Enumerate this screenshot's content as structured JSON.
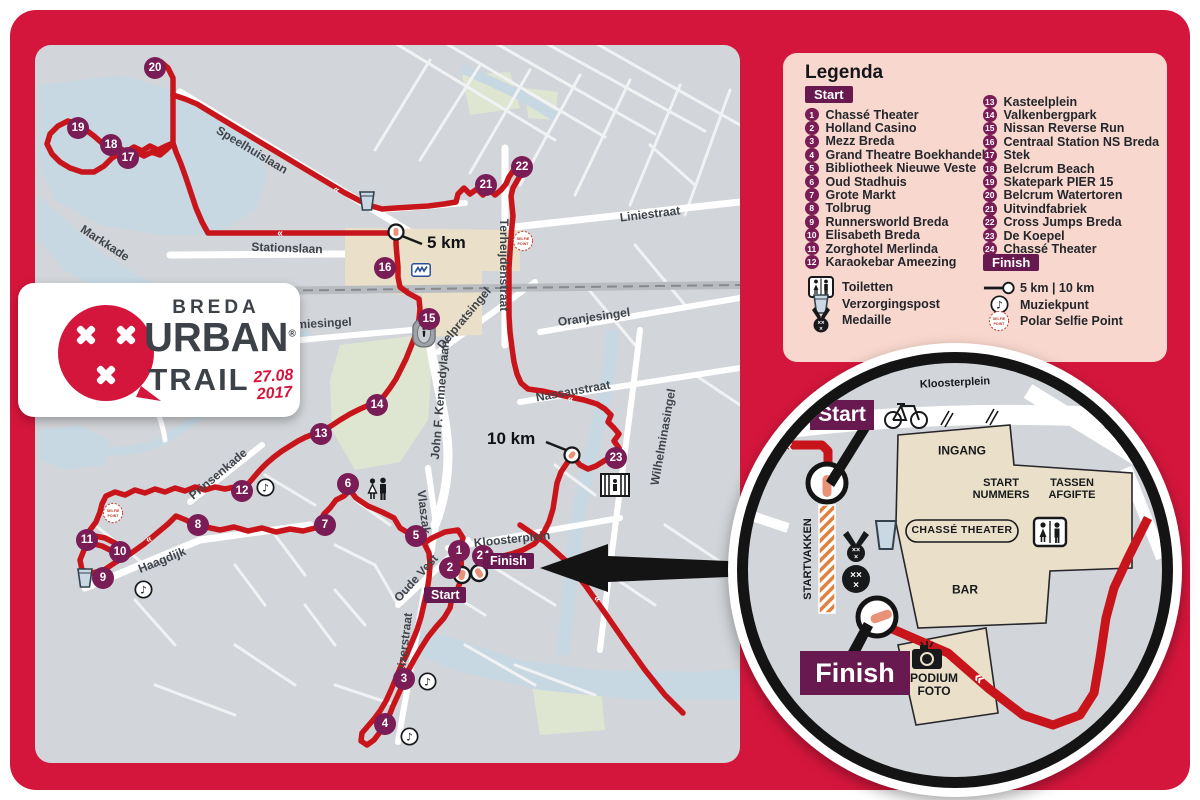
{
  "colors": {
    "frame": "#D5163C",
    "route": "#C8151B",
    "marker_purple": "#7A1C55",
    "badge_purple": "#681950",
    "legend_bg": "#F8D8CE",
    "map_bg": "#D2D5D9",
    "water": "#C7D8E3",
    "park": "#DEE6D2",
    "building": "#EADFC8",
    "startvakken_orange": "#E0813F",
    "marker_tick": "#E89277"
  },
  "logo": {
    "brand_top": "BREDA",
    "brand_mid": "URBAN",
    "registered_mark": "®",
    "brand_bottom": "TRAIL",
    "date_top": "27.08",
    "date_bottom": "2017"
  },
  "legend": {
    "title": "Legenda",
    "start_badge": "Start",
    "finish_badge": "Finish",
    "numbered_left": [
      "Chassé Theater",
      "Holland Casino",
      "Mezz Breda",
      "Grand Theatre Boekhandel",
      "Bibliotheek Nieuwe Veste",
      "Oud Stadhuis",
      "Grote Markt",
      "Tolbrug",
      "Runnersworld Breda",
      "Elisabeth Breda",
      "Zorghotel Merlinda",
      "Karaokebar Ameezing"
    ],
    "numbered_right": [
      "Kasteelplein",
      "Valkenbergpark",
      "Nissan Reverse Run",
      "Centraal Station NS Breda",
      "Stek",
      "Belcrum Beach",
      "Skatepark PIER 15",
      "Belcrum Watertoren",
      "Uitvindfabriek",
      "Cross Jumps Breda",
      "De Koepel",
      "Chassé Theater"
    ],
    "symbols_left": [
      {
        "icon": "toilet-icon",
        "label": "Toiletten"
      },
      {
        "icon": "cup-icon",
        "label": "Verzorgingspost"
      },
      {
        "icon": "medal-icon",
        "label": "Medaille"
      }
    ],
    "symbols_right": [
      {
        "icon": "km-marker-icon",
        "label": "5 km  |  10 km"
      },
      {
        "icon": "music-icon",
        "label": "Muziekpunt"
      },
      {
        "icon": "selfie-icon",
        "label": "Polar Selfie Point"
      }
    ]
  },
  "map": {
    "start_badge": "Start",
    "finish_badge": "Finish",
    "km_points": [
      {
        "label": "5 km",
        "x": 392,
        "y": 188
      },
      {
        "label": "10 km",
        "x": 452,
        "y": 384
      }
    ],
    "markers": [
      {
        "n": 1,
        "x": 424,
        "y": 506
      },
      {
        "n": 2,
        "x": 415,
        "y": 523
      },
      {
        "n": 3,
        "x": 369,
        "y": 634
      },
      {
        "n": 4,
        "x": 350,
        "y": 679
      },
      {
        "n": 5,
        "x": 381,
        "y": 491
      },
      {
        "n": 6,
        "x": 313,
        "y": 439
      },
      {
        "n": 7,
        "x": 290,
        "y": 480
      },
      {
        "n": 8,
        "x": 163,
        "y": 480
      },
      {
        "n": 9,
        "x": 68,
        "y": 533
      },
      {
        "n": 10,
        "x": 85,
        "y": 507
      },
      {
        "n": 11,
        "x": 52,
        "y": 495
      },
      {
        "n": 12,
        "x": 207,
        "y": 446
      },
      {
        "n": 13,
        "x": 286,
        "y": 389
      },
      {
        "n": 14,
        "x": 342,
        "y": 360
      },
      {
        "n": 15,
        "x": 394,
        "y": 274
      },
      {
        "n": 16,
        "x": 350,
        "y": 223
      },
      {
        "n": 17,
        "x": 93,
        "y": 113
      },
      {
        "n": 18,
        "x": 76,
        "y": 100
      },
      {
        "n": 19,
        "x": 43,
        "y": 83
      },
      {
        "n": 20,
        "x": 120,
        "y": 23
      },
      {
        "n": 21,
        "x": 451,
        "y": 140
      },
      {
        "n": 22,
        "x": 487,
        "y": 122
      },
      {
        "n": 23,
        "x": 581,
        "y": 413
      },
      {
        "n": 24,
        "x": 448,
        "y": 511
      }
    ],
    "street_labels": [
      {
        "text": "Speelhuislaan",
        "x": 217,
        "y": 105,
        "rot": 31
      },
      {
        "text": "Markkade",
        "x": 70,
        "y": 198,
        "rot": 33
      },
      {
        "text": "Stationslaan",
        "x": 252,
        "y": 203,
        "rot": 2
      },
      {
        "text": "Liniestraat",
        "x": 615,
        "y": 169,
        "rot": -7
      },
      {
        "text": "Terheijdenstraat",
        "x": 469,
        "y": 220,
        "rot": 90
      },
      {
        "text": "Delpratsingel",
        "x": 429,
        "y": 273,
        "rot": -50
      },
      {
        "text": "Oranjesingel",
        "x": 559,
        "y": 272,
        "rot": -8
      },
      {
        "text": "Nassaustraat",
        "x": 538,
        "y": 346,
        "rot": -10
      },
      {
        "text": "Wilhelminasingel",
        "x": 628,
        "y": 392,
        "rot": -80
      },
      {
        "text": "Academiesingel",
        "x": 271,
        "y": 279,
        "rot": -3
      },
      {
        "text": "John F. Kennedylaan",
        "x": 405,
        "y": 355,
        "rot": -85
      },
      {
        "text": "Prinsenkade",
        "x": 183,
        "y": 429,
        "rot": -40
      },
      {
        "text": "Haagdijk",
        "x": 127,
        "y": 515,
        "rot": -22
      },
      {
        "text": "Vlaszak",
        "x": 389,
        "y": 467,
        "rot": 83
      },
      {
        "text": "Oude Vest",
        "x": 381,
        "y": 533,
        "rot": -48
      },
      {
        "text": "Keizerstraat",
        "x": 369,
        "y": 602,
        "rot": -83
      },
      {
        "text": "Kloosterplein",
        "x": 477,
        "y": 494,
        "rot": -6
      }
    ],
    "icons": [
      {
        "icon": "cup-icon",
        "x": 41,
        "y": 522
      },
      {
        "icon": "cup-icon",
        "x": 323,
        "y": 145
      },
      {
        "icon": "selfie-icon",
        "x": 67,
        "y": 457
      },
      {
        "icon": "selfie-icon",
        "x": 477,
        "y": 185
      },
      {
        "icon": "music-icon",
        "x": 99,
        "y": 535
      },
      {
        "icon": "music-icon",
        "x": 221,
        "y": 433
      },
      {
        "icon": "music-icon",
        "x": 383,
        "y": 627
      },
      {
        "icon": "music-icon",
        "x": 365,
        "y": 682
      },
      {
        "icon": "couple-icon",
        "x": 330,
        "y": 432
      },
      {
        "icon": "stadium-icon",
        "x": 377,
        "y": 273
      },
      {
        "icon": "koepel-icon",
        "x": 565,
        "y": 428
      },
      {
        "icon": "ns-icon",
        "x": 376,
        "y": 218
      }
    ]
  },
  "inset": {
    "start_badge": "Start",
    "finish_badge": "Finish",
    "chasse_label": "CHASSÉ THEATER",
    "labels": [
      {
        "text": "Kloosterplein",
        "x": 207,
        "y": 20,
        "size": 11,
        "rot": -3,
        "weight": 600
      },
      {
        "text": "INGANG",
        "x": 214,
        "y": 88,
        "size": 12,
        "weight": 700
      },
      {
        "text": "START\nNUMMERS",
        "x": 253,
        "y": 126,
        "size": 11,
        "weight": 700
      },
      {
        "text": "TASSEN\nAFGIFTE",
        "x": 324,
        "y": 126,
        "size": 11,
        "weight": 700
      },
      {
        "text": "BAR",
        "x": 217,
        "y": 227,
        "size": 12,
        "weight": 700
      },
      {
        "text": "PODIUM\nFOTO",
        "x": 186,
        "y": 322,
        "size": 12,
        "weight": 700
      },
      {
        "text": "STARTVAKKEN",
        "x": 60,
        "y": 196,
        "size": 11,
        "rot": -90,
        "weight": 700
      }
    ]
  }
}
